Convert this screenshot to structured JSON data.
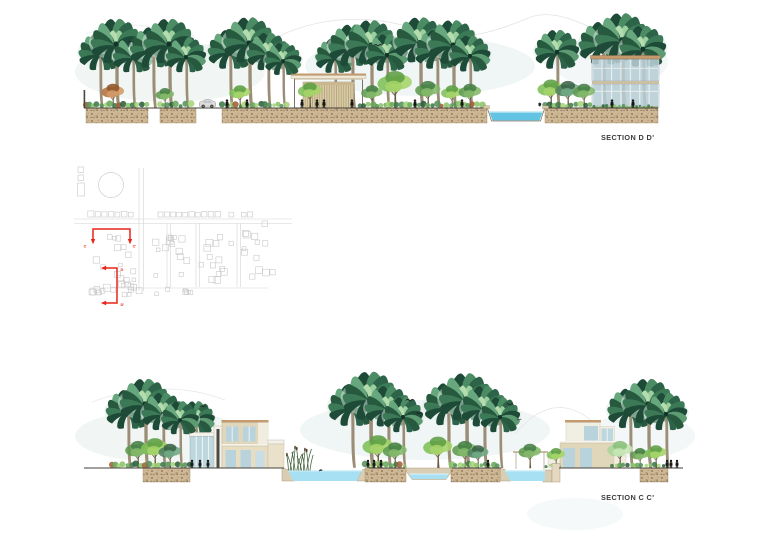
{
  "sections": {
    "dd": {
      "label": "SECTION D D'"
    },
    "cc": {
      "label": "SECTION C C'"
    }
  },
  "key_plan": {
    "marker_c_start": "C",
    "marker_c_end": "C'",
    "marker_d_start": "D",
    "marker_d_end": "D'",
    "section_line_color": "#e8251a",
    "plan_line_color": "#cbcbcb"
  },
  "palette": {
    "paper": "#ffffff",
    "ground_line": "#45423b",
    "soil": "#cdb795",
    "water_pool": "#62c3e2",
    "water_channel": "#a6e0f2",
    "palm_dark": "#1e4a38",
    "palm_light": "#67a77d",
    "canopy_green": "#7fbf58",
    "building_tan": "#e0d6ba",
    "glass_blue": "#b9d3dd",
    "roof_tan": "#c49a6e",
    "label_text": "#3b3b3b"
  }
}
